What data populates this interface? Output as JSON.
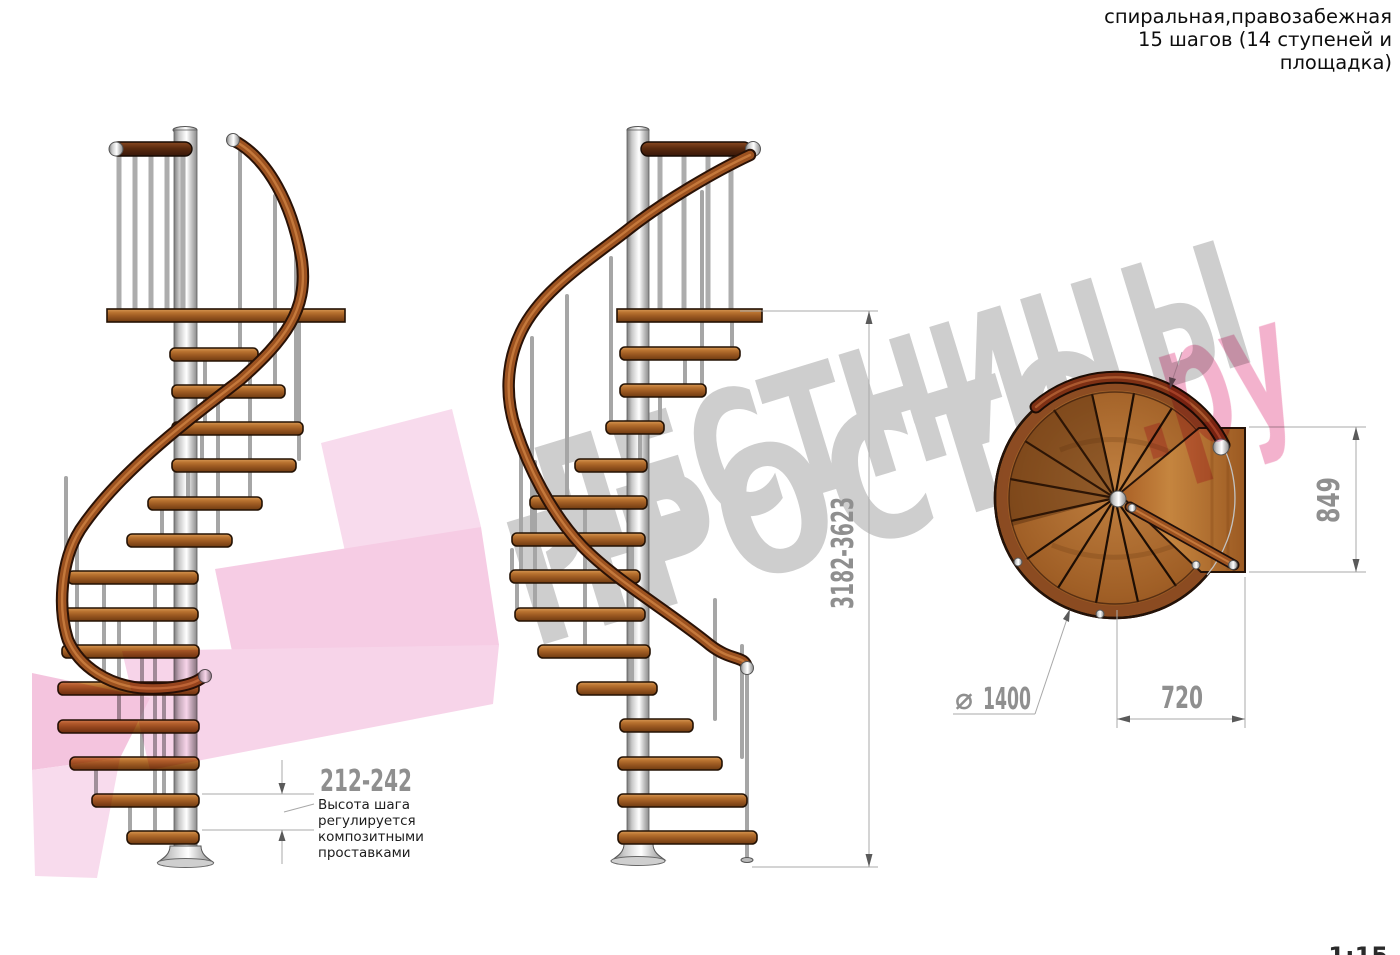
{
  "title": {
    "lines": [
      "спиральная,правозабежная",
      "15 шагов (14 ступеней и",
      "площадка)"
    ]
  },
  "watermark": {
    "line1": "ЛЕСТНИЦЫ",
    "line2": "ПРОСТО",
    "line2_suffix": ".ру"
  },
  "dims": {
    "step_height": "212-242",
    "step_note_lines": [
      "Высота шага",
      "регулируется",
      "композитными",
      "проставками"
    ],
    "total_height": "3182-3623",
    "platform_length": "849",
    "platform_width": "720",
    "diameter_symbol": "⌀",
    "diameter": "1400"
  },
  "scale": "1:15",
  "colors": {
    "wood": "#b8712f",
    "wood_dark": "#7a3c12",
    "handrail": "#9c5220",
    "metal": "#c9c9c9",
    "dimension_text": "#8f8f8f",
    "note_text": "#1c1c1c",
    "watermark_gray": "#cecece",
    "watermark_pink": "#f2a9c7"
  }
}
